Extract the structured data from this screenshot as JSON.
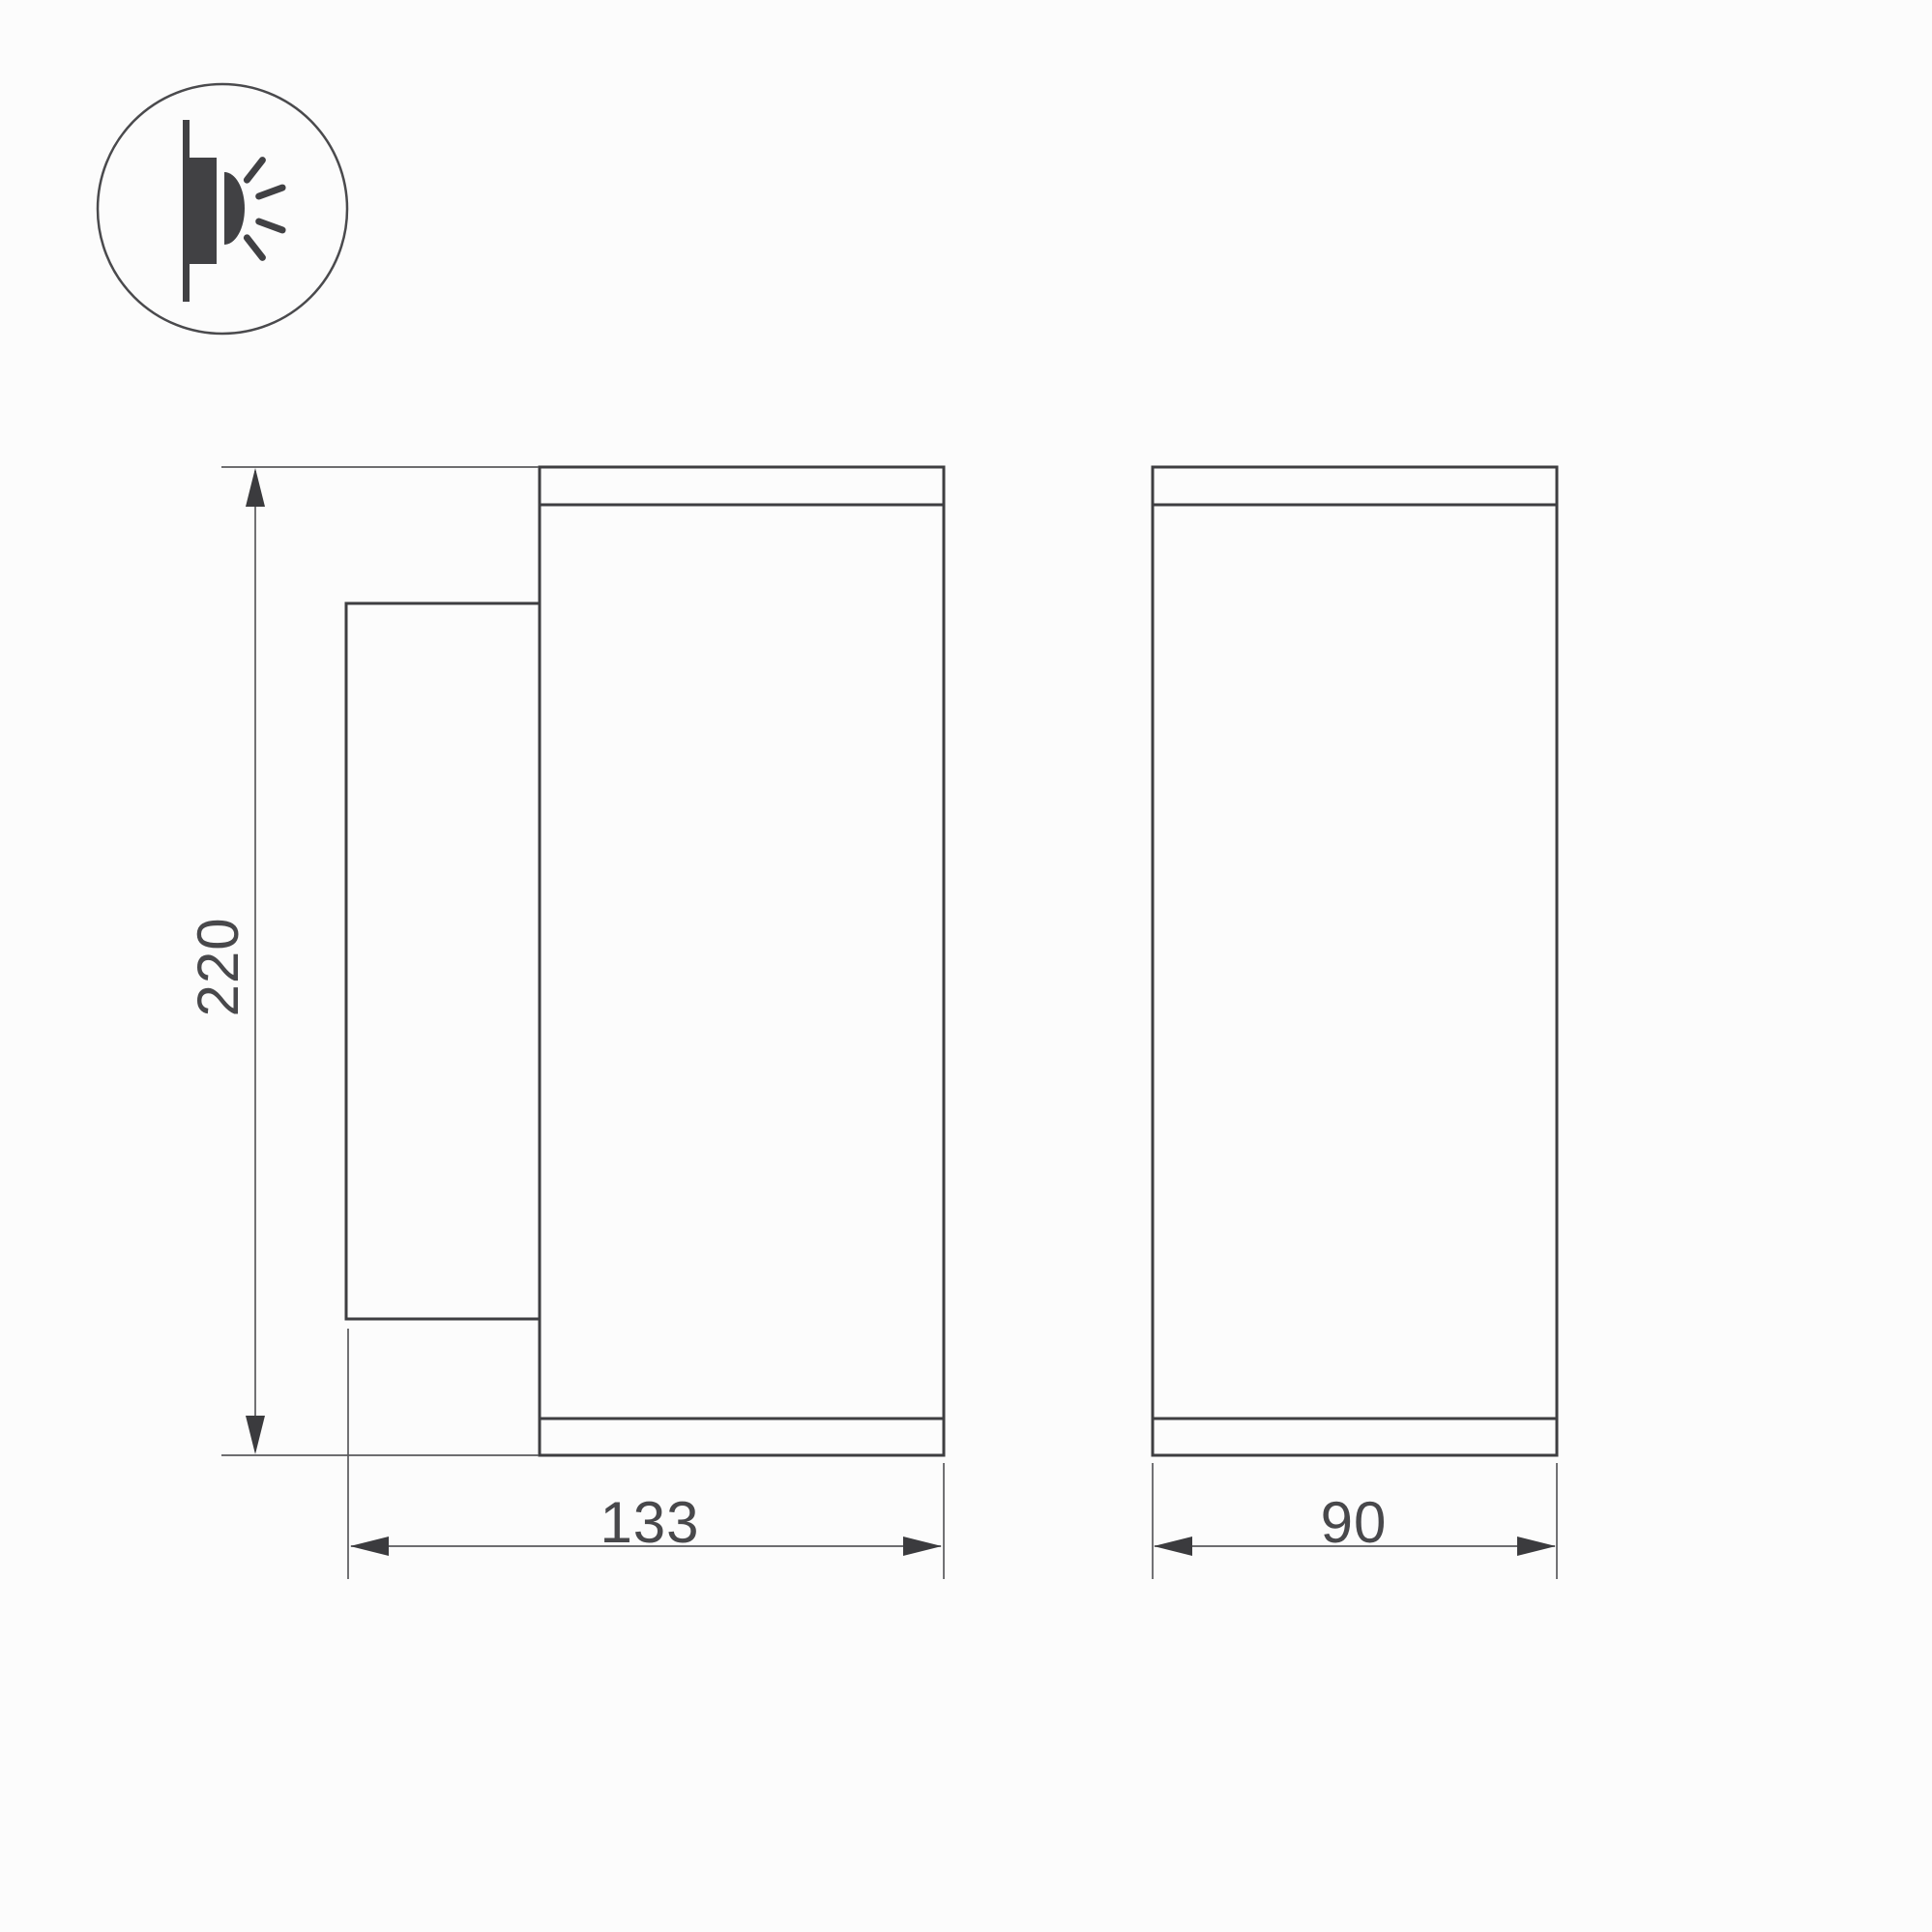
{
  "icon": {
    "name": "wall-mounted-light-side-emission-icon"
  },
  "dimensions": {
    "height": "220",
    "width_side": "133",
    "width_front": "90"
  },
  "colors": {
    "background": "#fcfcfc",
    "outline_bold": "#3e3e41",
    "outline_thin": "#5a5a5d",
    "arrow_fill": "#3b3b3e",
    "text": "#48484b",
    "icon_fill": "#414144"
  }
}
